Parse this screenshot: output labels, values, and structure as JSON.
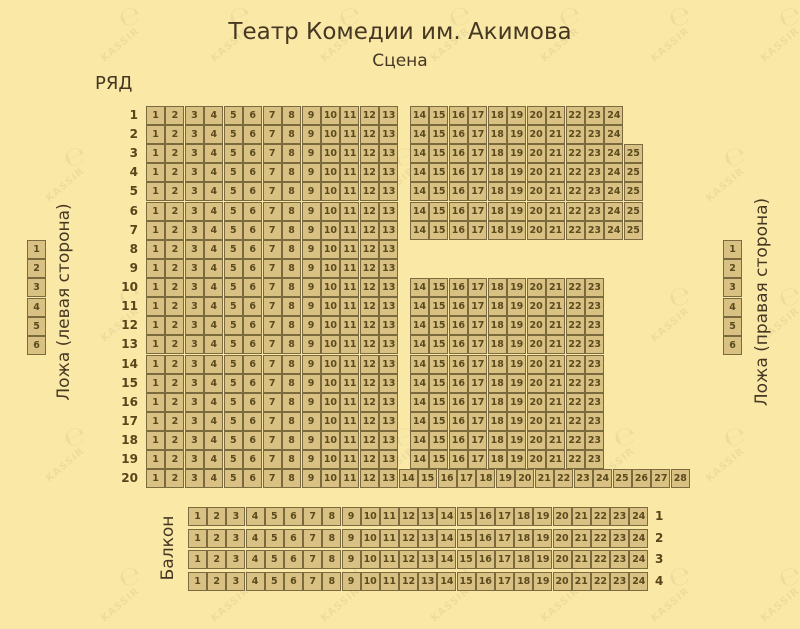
{
  "page": {
    "title": "Театр Комедии им. Акимова",
    "stage_label": "Сцена",
    "rows_header": "РЯД",
    "background_color": "#fae8a6"
  },
  "colors": {
    "seat_fill": "#d9c183",
    "seat_border": "#7a6a3e",
    "seat_text": "#5b4a1d",
    "heading_text": "#463723"
  },
  "main_hall": {
    "rows": [
      {
        "label": "1",
        "left": [
          1,
          13
        ],
        "right": [
          14,
          24
        ]
      },
      {
        "label": "2",
        "left": [
          1,
          13
        ],
        "right": [
          14,
          24
        ]
      },
      {
        "label": "3",
        "left": [
          1,
          13
        ],
        "right": [
          14,
          25
        ]
      },
      {
        "label": "4",
        "left": [
          1,
          13
        ],
        "right": [
          14,
          25
        ]
      },
      {
        "label": "5",
        "left": [
          1,
          13
        ],
        "right": [
          14,
          25
        ]
      },
      {
        "label": "6",
        "left": [
          1,
          13
        ],
        "right": [
          14,
          25
        ]
      },
      {
        "label": "7",
        "left": [
          1,
          13
        ],
        "right": [
          14,
          25
        ]
      },
      {
        "label": "8",
        "left": [
          1,
          13
        ],
        "right": null
      },
      {
        "label": "9",
        "left": [
          1,
          13
        ],
        "right": null
      },
      {
        "label": "10",
        "left": [
          1,
          13
        ],
        "right": [
          14,
          23
        ]
      },
      {
        "label": "11",
        "left": [
          1,
          13
        ],
        "right": [
          14,
          23
        ]
      },
      {
        "label": "12",
        "left": [
          1,
          13
        ],
        "right": [
          14,
          23
        ]
      },
      {
        "label": "13",
        "left": [
          1,
          13
        ],
        "right": [
          14,
          23
        ]
      },
      {
        "label": "14",
        "left": [
          1,
          13
        ],
        "right": [
          14,
          23
        ]
      },
      {
        "label": "15",
        "left": [
          1,
          13
        ],
        "right": [
          14,
          23
        ]
      },
      {
        "label": "16",
        "left": [
          1,
          13
        ],
        "right": [
          14,
          23
        ]
      },
      {
        "label": "17",
        "left": [
          1,
          13
        ],
        "right": [
          14,
          23
        ]
      },
      {
        "label": "18",
        "left": [
          1,
          13
        ],
        "right": [
          14,
          23
        ]
      },
      {
        "label": "19",
        "left": [
          1,
          13
        ],
        "right": [
          14,
          23
        ]
      },
      {
        "label": "20",
        "full": [
          1,
          28
        ]
      }
    ]
  },
  "loge_left": {
    "label": "Ложа (левая сторона)",
    "seats": [
      1,
      6
    ]
  },
  "loge_right": {
    "label": "Ложа (правая сторона)",
    "seats": [
      1,
      6
    ]
  },
  "balcony": {
    "label": "Балкон",
    "rows": [
      {
        "label": "1",
        "seats": [
          1,
          24
        ]
      },
      {
        "label": "2",
        "seats": [
          1,
          24
        ]
      },
      {
        "label": "3",
        "seats": [
          1,
          24
        ]
      },
      {
        "label": "4",
        "seats": [
          1,
          24
        ]
      }
    ]
  },
  "watermark": {
    "text": "KASSIR",
    "glyph": "℮"
  }
}
